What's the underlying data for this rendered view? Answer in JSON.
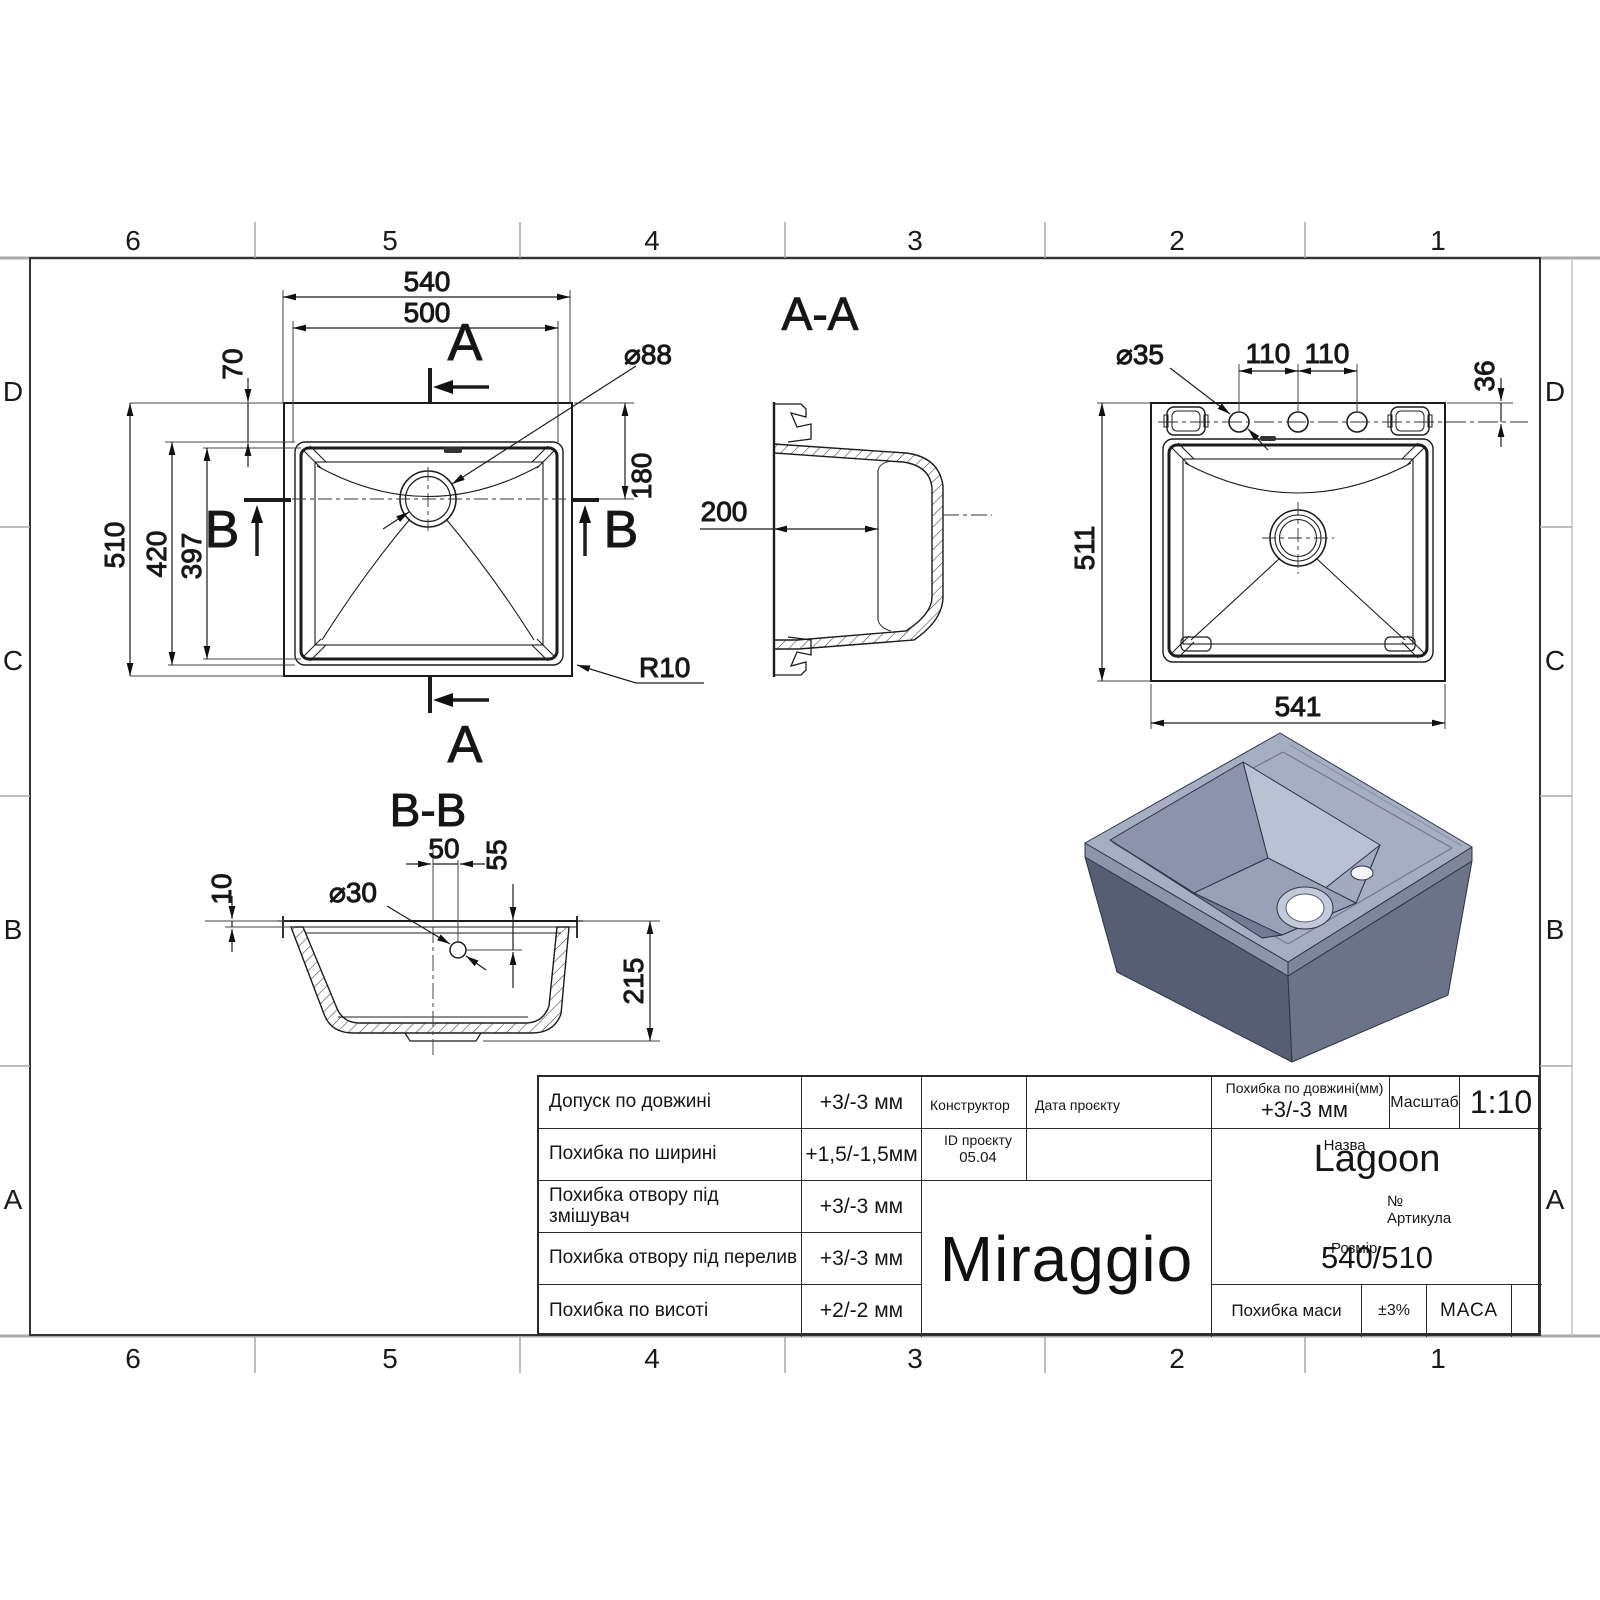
{
  "grid": {
    "columns": [
      "6",
      "5",
      "4",
      "3",
      "2",
      "1"
    ],
    "rows": [
      "D",
      "C",
      "B",
      "A"
    ]
  },
  "plan_view": {
    "section_a_label": "A",
    "section_b_label": "B",
    "dim_outer_width": "540",
    "dim_inner_width": "500",
    "dim_top_offset": "70",
    "dim_outer_height": "510",
    "dim_inner_height": "420",
    "dim_bowl_height": "397",
    "dim_drain_diameter": "⌀88",
    "dim_drain_from_top": "180",
    "dim_corner_radius": "R10"
  },
  "section_aa": {
    "title": "A-A",
    "dim_depth": "200"
  },
  "section_bb": {
    "title": "B-B",
    "dim_drain_offset": "50",
    "dim_drain_depth": "55",
    "dim_hole_diameter": "⌀30",
    "dim_rim_thickness": "10",
    "dim_total_height": "215"
  },
  "bottom_view": {
    "dim_hole_diameter": "⌀35",
    "dim_hole_spacing_left": "110",
    "dim_hole_spacing_right": "110",
    "dim_hole_from_edge": "36",
    "dim_height": "511",
    "dim_width": "541"
  },
  "title_block": {
    "tolerances": [
      {
        "label": "Допуск по довжині",
        "value": "+3/-3 мм"
      },
      {
        "label": "Похибка по ширині",
        "value": "+1,5/-1,5мм"
      },
      {
        "label": "Похибка отвору під змішувач",
        "value": "+3/-3 мм"
      },
      {
        "label": "Похибка отвору під перелив",
        "value": "+3/-3 мм"
      },
      {
        "label": "Похибка по висоті",
        "value": "+2/-2 мм"
      }
    ],
    "designer_label": "Конструктор",
    "project_date_label": "Дата проєкту",
    "project_id_label": "ID проєкту",
    "project_id_value": "05.04",
    "brand": "Miraggio",
    "length_tolerance_label": "Похибка по довжині(мм)",
    "length_tolerance_value": "+3/-3 мм",
    "scale_label": "Масштаб",
    "scale_value": "1:10",
    "name_label": "Назва",
    "name_value": "Lagoon",
    "article_label": "№ Артикула",
    "size_label": "Розмір",
    "size_value": "540/510",
    "mass_tolerance_label": "Похибка маси",
    "mass_tolerance_value": "±3%",
    "mass_label": "МАСА"
  },
  "colors": {
    "line": "#1c1c1c",
    "sink_top": "#a7aec3",
    "sink_inner_light": "#bac1d3",
    "sink_side_dark": "#575d73",
    "sink_side_mid": "#6c7389"
  }
}
